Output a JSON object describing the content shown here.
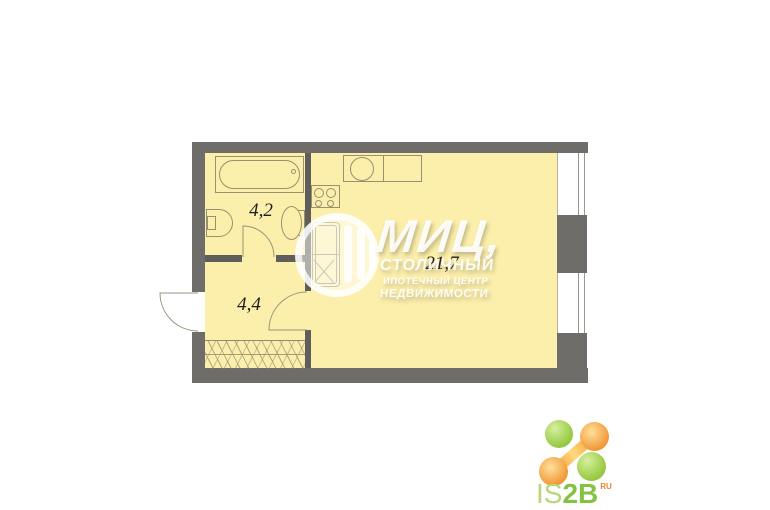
{
  "plan": {
    "rooms": [
      {
        "id": "bathroom",
        "area": "4,2"
      },
      {
        "id": "hallway",
        "area": "4,4"
      },
      {
        "id": "living-kitchen",
        "area": "21,7"
      }
    ],
    "colors": {
      "room_fill": "#FCEFAC",
      "wall": "#6E6D69",
      "outline": "#97916F"
    }
  },
  "watermark": {
    "title": "МИЦ,",
    "line2": "СТОЛИЧНЫЙ",
    "line3": "ИПОТЕЧНЫЙ ЦЕНТР",
    "line4": "НЕДВИЖИМОСТИ"
  },
  "brand": {
    "is": "IS",
    "twob": "2B",
    "sup": "RU",
    "green": "#8DC63F",
    "orange": "#F0912C"
  }
}
